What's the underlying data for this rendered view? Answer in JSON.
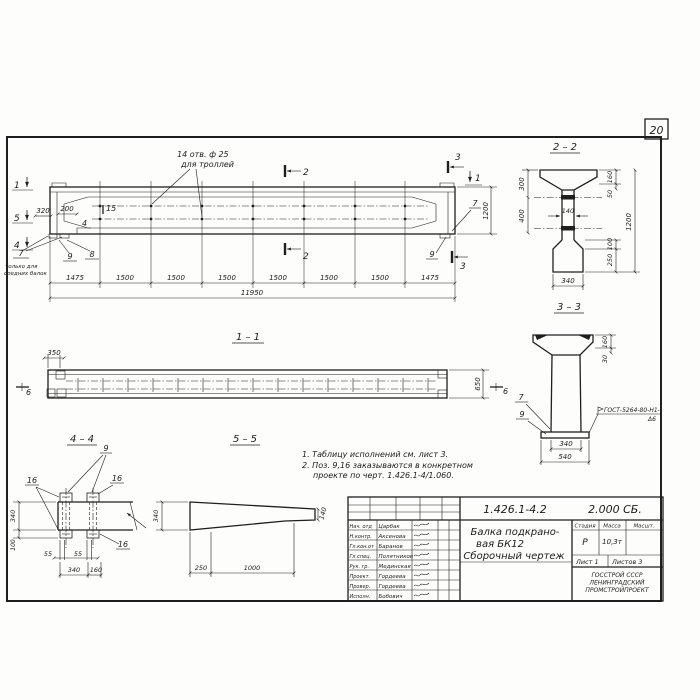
{
  "sheet": {
    "page_number": "20",
    "notes": {
      "line1": "1. Таблицу исполнений см. лист 3.",
      "line2": "2. Поз. 9,16 заказываются в конкретном",
      "line3": "проекте по черт. 1.426.1-4/1.060."
    }
  },
  "elevation": {
    "hole_note_line1": "14 отв. ф 25",
    "hole_note_line2": "для троллей",
    "bearing_note_line1": "только для",
    "bearing_note_line2": "средних балок",
    "marks": {
      "m1": "1",
      "m2": "2",
      "m3": "3",
      "m4": "4",
      "m5": "5"
    },
    "pos": {
      "p4": "4",
      "p7": "7",
      "p8": "8",
      "p9": "9",
      "p15": "15"
    },
    "dims": {
      "d320": "320",
      "d200": "200",
      "d1200": "1200",
      "total": "11950",
      "segments": [
        "1475",
        "1500",
        "1500",
        "1500",
        "1500",
        "1500",
        "1500",
        "1475"
      ]
    }
  },
  "sections": {
    "s11": {
      "title": "1 – 1",
      "d350": "350",
      "d650": "650",
      "mark6": "6"
    },
    "s22": {
      "title": "2 – 2",
      "d300": "300",
      "d400": "400",
      "d160": "160",
      "d50": "50",
      "d140": "140",
      "d1200": "1200",
      "d100": "100",
      "d250": "250",
      "d340": "340"
    },
    "s33": {
      "title": "3 – 3",
      "d160": "160",
      "d30": "30",
      "d340": "340",
      "d540": "540",
      "p7": "7",
      "p9": "9",
      "weld1": "ГОСТ-5264-80-Н1-",
      "weld2": "Δ6"
    },
    "s44": {
      "title": "4 – 4",
      "p9": "9",
      "p16": "16",
      "d340side": "340",
      "d100": "100",
      "d55": "55",
      "d340": "340",
      "d160": "160"
    },
    "s55": {
      "title": "5 – 5",
      "d340": "340",
      "d140": "140",
      "d250": "250",
      "d1000": "1000"
    }
  },
  "title_block": {
    "doc_number": "1.426.1-4.2",
    "doc_suffix": "2.000 СБ.",
    "title_line1": "Балка подкрано-",
    "title_line2": "вая БК12",
    "title_line3": "Сборочный чертеж",
    "cols": {
      "stage": "Стадия",
      "mass": "Масса",
      "scale": "Масшт."
    },
    "values": {
      "stage": "Р",
      "mass": "10,3т",
      "scale": ""
    },
    "sheet_info": {
      "sheet": "Лист 1",
      "sheets": "Листов 3"
    },
    "org_line1": "ГОССТРОЙ СССР",
    "org_line2": "ЛЕНИНГРАДСКИЙ",
    "org_line3": "ПРОМСТРОЙПРОЕКТ",
    "signatures": [
      {
        "role": "Нач. отд",
        "name": "Царбак"
      },
      {
        "role": "Н.контр.",
        "name": "Аксенова"
      },
      {
        "role": "Гл.кон.от",
        "name": "Баранов"
      },
      {
        "role": "Гл.спец.",
        "name": "Полятников"
      },
      {
        "role": "Рук. гр.",
        "name": "Мединская"
      },
      {
        "role": "Проект.",
        "name": "Гордеева"
      },
      {
        "role": "Провер.",
        "name": "Гордеева"
      },
      {
        "role": "Исполн.",
        "name": "Бобович"
      }
    ]
  },
  "colors": {
    "ink": "#1f1f1f",
    "paper": "#fdfdfc"
  }
}
